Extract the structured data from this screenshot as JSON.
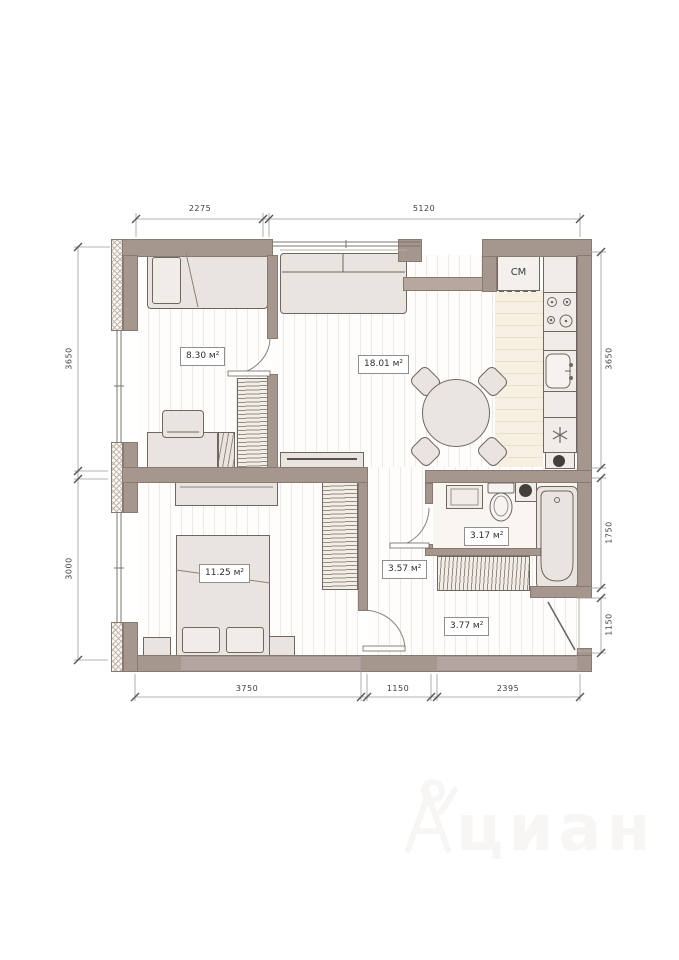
{
  "watermark": {
    "text": "циан"
  },
  "dimensions": {
    "top": [
      {
        "label": "2275"
      },
      {
        "label": "5120"
      }
    ],
    "left": [
      {
        "label": "3650"
      },
      {
        "label": "3000"
      }
    ],
    "right": [
      {
        "label": "3650"
      },
      {
        "label": "1750"
      },
      {
        "label": "1150"
      }
    ],
    "bottom": [
      {
        "label": "3750"
      },
      {
        "label": "1150"
      },
      {
        "label": "2395"
      }
    ]
  },
  "rooms": [
    {
      "name": "bedroom-small",
      "area_label": "8.30 м²"
    },
    {
      "name": "living-kitchen",
      "area_label": "18.01 м²"
    },
    {
      "name": "bedroom-master",
      "area_label": "11.25 м²"
    },
    {
      "name": "bathroom",
      "area_label": "3.17 м²"
    },
    {
      "name": "hallway",
      "area_label": "3.57 м²"
    },
    {
      "name": "entry",
      "area_label": "3.77 м²"
    }
  ],
  "appliances": {
    "washing_machine_label": "СМ"
  },
  "colors": {
    "wall": "#a5968e",
    "kitchen_floor": "#f7f0e2",
    "furniture_fill": "#e9e4df",
    "furniture_outline": "#6f6761",
    "dimension_text": "#3d3d3d"
  }
}
